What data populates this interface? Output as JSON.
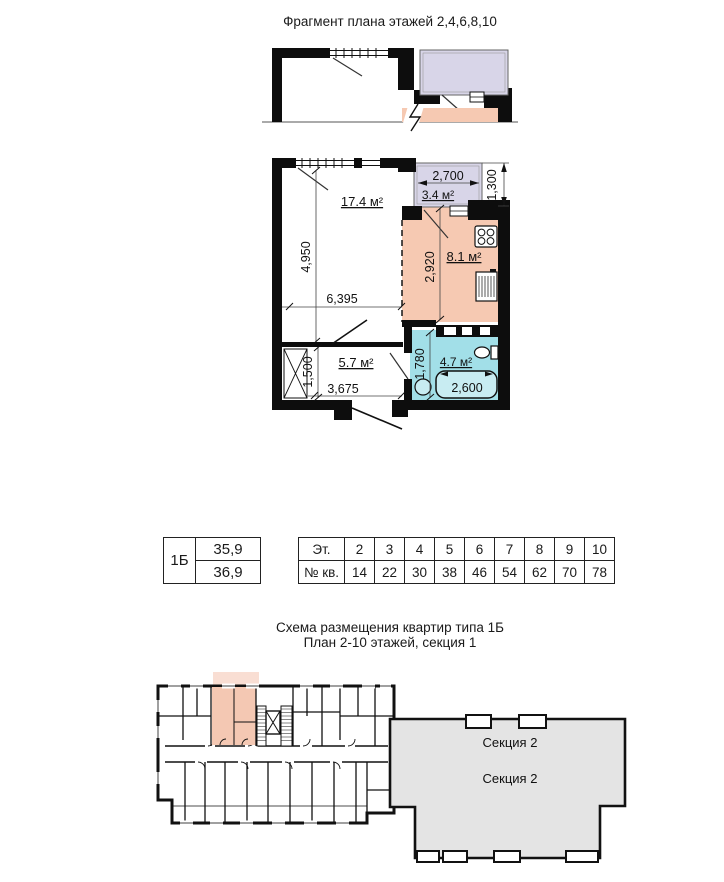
{
  "titles": {
    "fragment": "Фрагмент плана этажей 2,4,6,8,10",
    "scheme_line1": "Схема размещения квартир типа 1Б",
    "scheme_line2": "План 2-10 этажей, секция 1"
  },
  "plan": {
    "areas": {
      "living": "17.4 м²",
      "balcony": "3.4 м²",
      "kitchen": "8.1 м²",
      "hall": "5.7 м²",
      "bath": "4.7 м²"
    },
    "dims": {
      "balcony_width": "2,700",
      "balcony_depth": "1,300",
      "living_height": "4,950",
      "kitchen_height": "2,920",
      "living_width": "6,395",
      "hall_height": "1,500",
      "hall_width": "3,675",
      "bath_height": "1,780",
      "bath_width": "2,600"
    }
  },
  "type_table": {
    "type": "1Б",
    "living_area": "35,9",
    "total_area": "36,9"
  },
  "floors_table": {
    "floor_header": "Эт.",
    "apt_header": "№ кв.",
    "floors": [
      "2",
      "3",
      "4",
      "5",
      "6",
      "7",
      "8",
      "9",
      "10"
    ],
    "apartments": [
      "14",
      "22",
      "30",
      "38",
      "46",
      "54",
      "62",
      "70",
      "78"
    ]
  },
  "building": {
    "section2": "Секция 2"
  },
  "colors": {
    "balcony": "#d8d5e8",
    "kitchen": "#f6c9b2",
    "bath": "#a2dfe8",
    "section2": "#e4e4e4",
    "highlight": "#f4c8b3"
  }
}
